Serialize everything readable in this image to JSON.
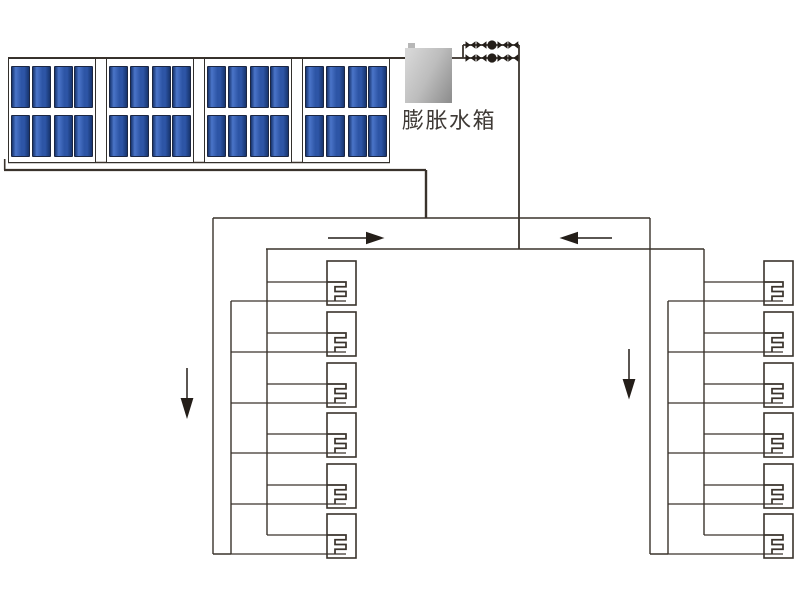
{
  "page": {
    "background": "#ffffff"
  },
  "tank": {
    "label": "膨胀水箱",
    "gradient": [
      "#d6d6d6",
      "#bdbdbd",
      "#909090"
    ],
    "label_color": "#3f3a36"
  },
  "collectors": {
    "group_count": 4,
    "rows_per_group": 2,
    "panels_per_row": 4,
    "panel_color_dark": "#17356f",
    "panel_color_mid": "#2d55a6",
    "panel_color_light": "#4a74c8",
    "frame_color": "#33302c"
  },
  "piping": {
    "line_color": "#3a332c",
    "symbol_color": "#241e19",
    "valve_rows": 2,
    "valves_per_row": 4,
    "pumps_per_row": 1
  },
  "radiators": {
    "left_count": 6,
    "right_count": 6
  },
  "arrows": {
    "top_flow_left_direction": "right",
    "top_flow_right_direction": "left",
    "left_column_direction": "down",
    "right_column_direction": "down"
  }
}
